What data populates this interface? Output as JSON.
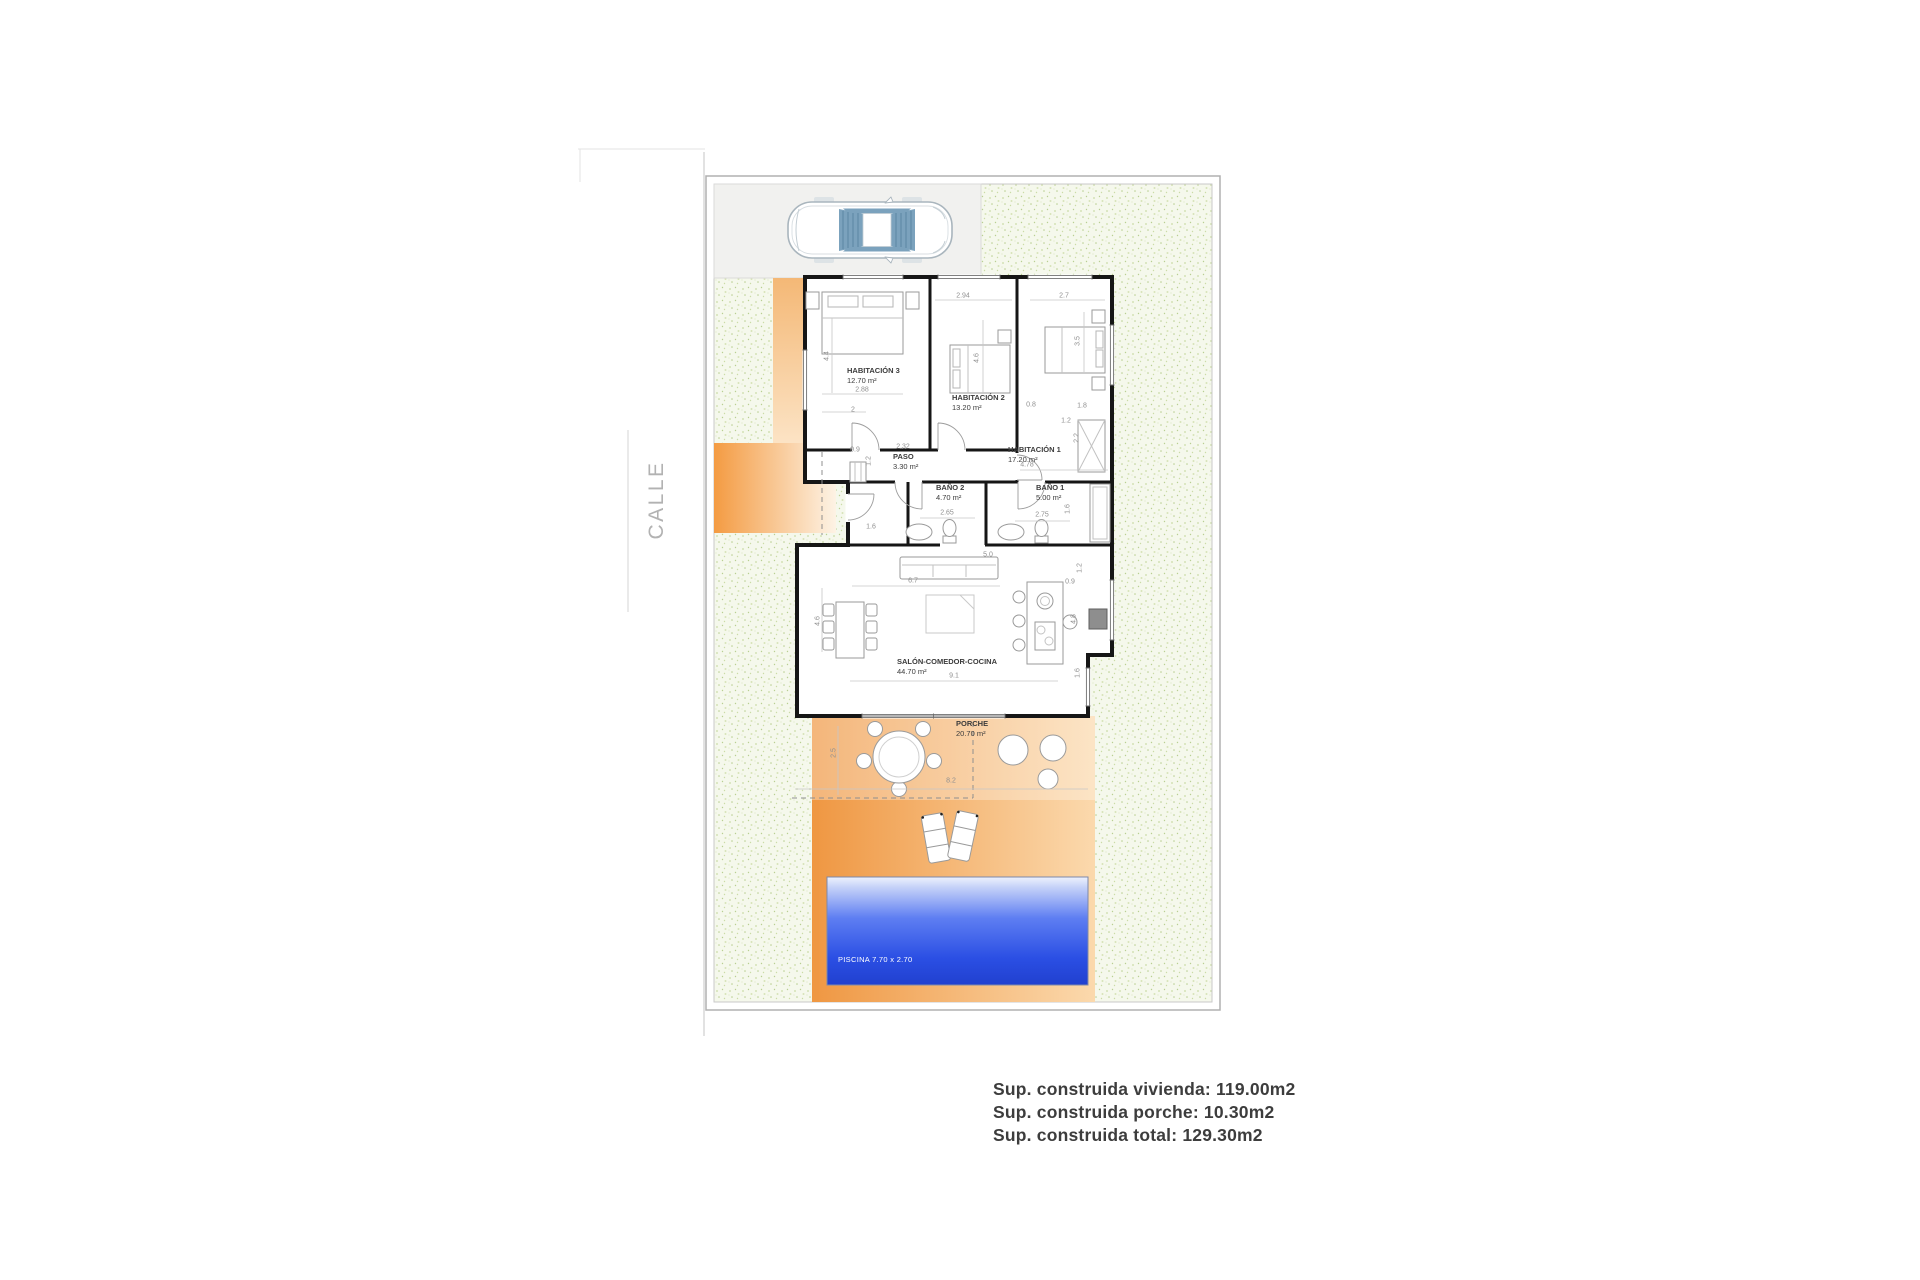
{
  "street": {
    "label": "CALLE"
  },
  "rooms": {
    "hab3": {
      "name": "HABITACIÓN 3",
      "area": "12.70 m²"
    },
    "hab2": {
      "name": "HABITACIÓN 2",
      "area": "13.20 m²"
    },
    "hab1": {
      "name": "HABITACIÓN 1",
      "area": "17.20 m²"
    },
    "paso": {
      "name": "PASO",
      "area": "3.30 m²"
    },
    "bano2": {
      "name": "BAÑO 2",
      "area": "4.70 m²"
    },
    "bano1": {
      "name": "BAÑO 1",
      "area": "5.00 m²"
    },
    "salon": {
      "name": "SALÓN-COMEDOR-COCINA",
      "area": "44.70 m²"
    },
    "porche": {
      "name": "PORCHE",
      "area": "20.70 m²"
    }
  },
  "pool": {
    "label": "PISCINA 7.70 x 2.70"
  },
  "dimensions": [
    "2.88",
    "2",
    "4.4",
    "2.94",
    "4.6",
    "2.7",
    "3.5",
    "0.8",
    "1.8",
    "2.32",
    "0.9",
    "1.2",
    "4.78",
    "1.2",
    "2.2",
    "2.65",
    "2.75",
    "1.6",
    "1.6",
    "6.7",
    "9.1",
    "4.6",
    "0.9",
    "1.2",
    "4.8",
    "1.6",
    "5.0",
    "2.5",
    "8.2"
  ],
  "summary": {
    "vivienda": "Sup. construida vivienda: 119.00m2",
    "porche": "Sup. construida porche: 10.30m2",
    "total": "Sup. construida total: 129.30m2"
  },
  "colors": {
    "accent_orange": "#ef9742",
    "pool_blue": "#2b4fe4",
    "garden_green": "#f5f8ec"
  }
}
